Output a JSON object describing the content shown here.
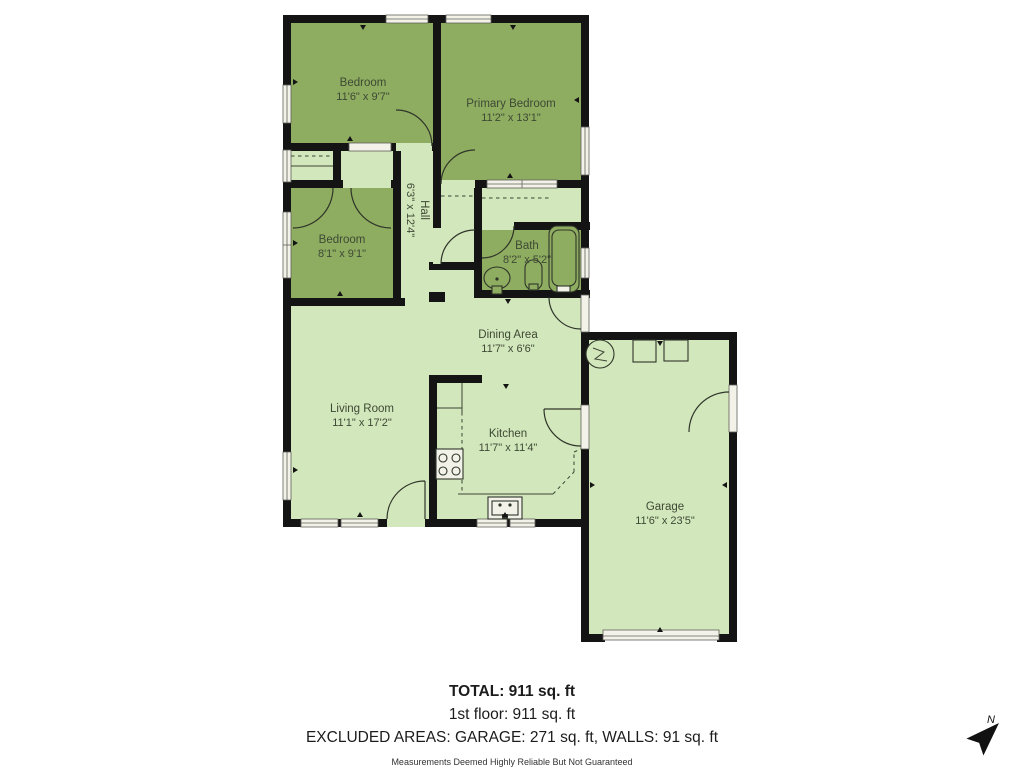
{
  "plan": {
    "rooms": {
      "bedroom_top": {
        "name": "Bedroom",
        "dims": "11'6\" x 9'7\""
      },
      "primary_bedroom": {
        "name": "Primary Bedroom",
        "dims": "11'2\" x 13'1\""
      },
      "bedroom_mid": {
        "name": "Bedroom",
        "dims": "8'1\" x 9'1\""
      },
      "hall": {
        "name": "Hall",
        "dims": "6'3\" x 12'4\""
      },
      "bath": {
        "name": "Bath",
        "dims": "8'2\" x 5'2\""
      },
      "dining": {
        "name": "Dining Area",
        "dims": "11'7\" x 6'6\""
      },
      "living": {
        "name": "Living Room",
        "dims": "11'1\" x 17'2\""
      },
      "kitchen": {
        "name": "Kitchen",
        "dims": "11'7\" x 11'4\""
      },
      "garage": {
        "name": "Garage",
        "dims": "11'6\" x 23'5\""
      }
    },
    "colors": {
      "room_dark": "#8fad60",
      "room_light": "#d2e7bb",
      "wall": "#141414"
    },
    "compass_label": "N"
  },
  "footer": {
    "total": "TOTAL: 911 sq. ft",
    "floor": "1st floor: 911 sq. ft",
    "excluded": "EXCLUDED AREAS: GARAGE: 271 sq. ft, WALLS: 91 sq. ft",
    "disclaimer": "Measurements Deemed Highly Reliable But Not Guaranteed"
  }
}
